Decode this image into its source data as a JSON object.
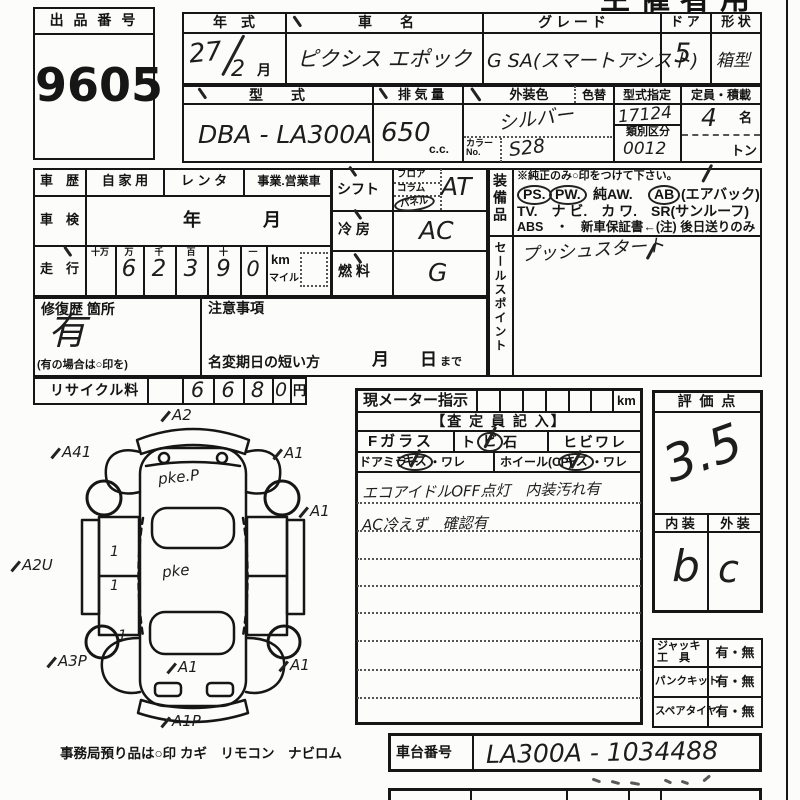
{
  "header": {
    "use": "主催者用"
  },
  "lot": {
    "label": "出 品 番 号",
    "number": "9605"
  },
  "top": {
    "year_label": "年　式",
    "year": "27",
    "year2": "2",
    "month": "月",
    "name_label": "車　　名",
    "name": "ピクシス エポック",
    "grade_label": "グ レ ー ド",
    "grade": "G SA(スマートアシスト)",
    "door_label": "ド ア",
    "door": "5",
    "shape_label": "形 状",
    "shape": "箱型",
    "model_label": "型　　式",
    "model": "DBA - LA300A",
    "disp_label": "排 気 量",
    "disp": "650",
    "disp_unit": "c.c.",
    "color_label": "外装色",
    "color_change_label": "色替",
    "color": "シルバー",
    "color_no_label": "カラー\nNo.",
    "color_no": "S28",
    "type_label": "型式指定",
    "type_no": "17124",
    "class_label": "類別区分",
    "class_no": "0012",
    "cap_label": "定員・積載",
    "cap": "4",
    "cap_unit": "名",
    "ton": "トン"
  },
  "history": {
    "rireki_label": "車　歴",
    "own": "自 家 用",
    "rental": "レ ン タ",
    "business": "事業.営業車",
    "shaken_label": "車　検",
    "year": "年",
    "month": "月",
    "soko_label": "走　行",
    "units": [
      "十万",
      "万",
      "千",
      "百",
      "十",
      "一"
    ],
    "digits": [
      "6",
      "2",
      "3",
      "9",
      "0"
    ],
    "km": "km",
    "mile": "マイル",
    "repair_label": "修復歴 箇所",
    "repair_value": "有",
    "repair_note": "(有の場合は○印を)",
    "caution_label": "注意事項",
    "rename_label": "名変期日の短い方",
    "rename_month": "月",
    "rename_day": "日",
    "rename_made": "まで",
    "recycle_label": "リサイクル料",
    "recycle_digits": [
      "6",
      "6",
      "8",
      "0"
    ],
    "yen": "円"
  },
  "drive": {
    "shift_label": "シフト",
    "opts": [
      "フロア",
      "コラム",
      "パネル"
    ],
    "shift": "AT",
    "cool_label": "冷 房",
    "cool": "AC",
    "fuel_label": "燃 料",
    "fuel": "G"
  },
  "equipment": {
    "label": "装備品",
    "note": "※純正のみ○印をつけて下さい。",
    "l2a": "PS.",
    "l2b": "PW.",
    "l2c": "純AW.",
    "l2d": "AB",
    "l2e": "(エアバック)",
    "l3": "TV.　ナ ビ.　カ ワ.　SR(サンルーフ)",
    "l4": "ABS　・　新車保証書←(注) 後日送りのみ"
  },
  "sales": {
    "label": "セールスポイント",
    "point": "プッシュスタート"
  },
  "meter": {
    "label": "現メーター指示",
    "km": "km",
    "assessor": "【査 定 員 記 入】",
    "fglass": "Fガラス",
    "tobi_a": "ト",
    "tobi_b": "ビ",
    "tobi_c": "石",
    "hibi": "ヒビワレ",
    "mirror": "ドアミラー",
    "kizu1": "キズ",
    "ware1": "・ワレ",
    "wheel": "ホイール(CP)",
    "kizu2": "キズ",
    "ware2": "・ワレ",
    "note1": "エコアイドルOFF点灯　内装汚れ有",
    "note2": "AC冷えず　確認有"
  },
  "rating": {
    "label": "評 価 点",
    "score": "3.5",
    "interior_label": "内 装",
    "exterior_label": "外 装",
    "interior": "b",
    "exterior": "c"
  },
  "tools": {
    "t1": "ジャッキ\n工　具",
    "v1": "有・無",
    "t2": "パンクキット",
    "v2": "有・無",
    "t3": "スペアタイヤ",
    "v3": "有・無"
  },
  "chassis": {
    "label": "車台番号",
    "number": "LA300A - 1034488"
  },
  "footer": {
    "label": "事務局預り品は○印",
    "items": "カギ　リモコン　ナビロム"
  },
  "diagram": {
    "ann": [
      "A2",
      "A41",
      "A1",
      "A2U",
      "A1",
      "A3P",
      "A1",
      "A1",
      "A1P"
    ],
    "body_notes": [
      "pke.P",
      "pke"
    ],
    "ones": [
      "1",
      "1",
      "1"
    ]
  }
}
